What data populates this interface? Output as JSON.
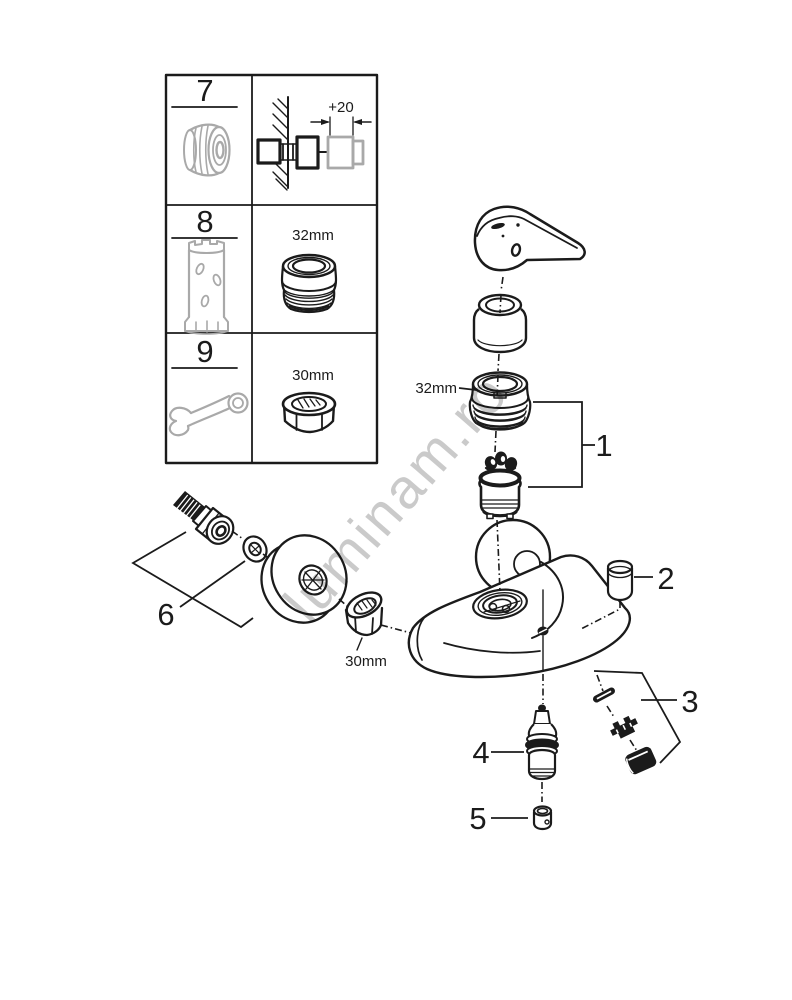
{
  "diagram": {
    "title_hint": "faucet-exploded-parts-diagram",
    "watermark": "luminam.ro",
    "parts_table": {
      "rows": [
        {
          "id": "7",
          "icon": "extension-nipple-icon",
          "detail": "+20"
        },
        {
          "id": "8",
          "icon": "socket-tool-icon",
          "detail": "32mm"
        },
        {
          "id": "9",
          "icon": "open-end-wrench-icon",
          "detail": "30mm"
        }
      ]
    },
    "callouts": [
      "1",
      "2",
      "3",
      "4",
      "5",
      "6"
    ],
    "dimensions": {
      "wall_offset": "+20",
      "cartridge_ring": "32mm",
      "mounting_nut": "30mm"
    },
    "colors": {
      "line": "#1b1b1b",
      "tool_gray": "#a9a9a9",
      "watermark_gray": "#c4c4c4"
    }
  }
}
